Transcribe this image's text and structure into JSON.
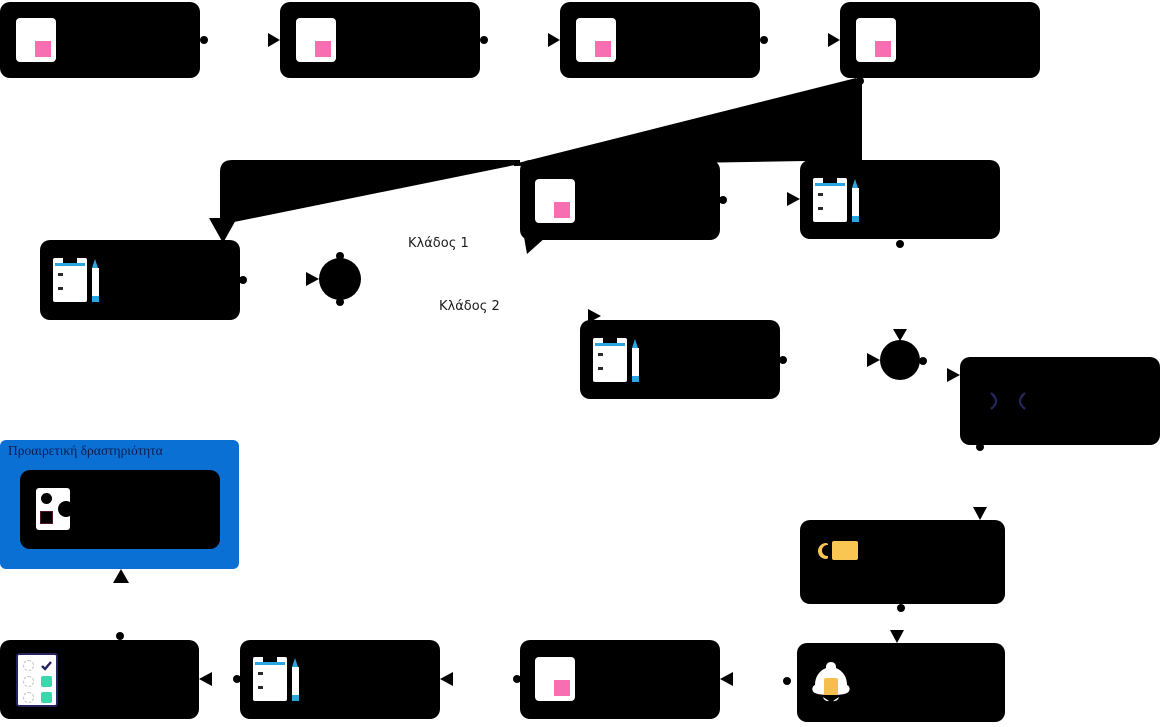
{
  "labels": {
    "branch1": "Κλάδος 1",
    "branch2": "Κλάδος 2",
    "optional_group": "Προαιρετική δραστηριότητα"
  },
  "colors": {
    "node_black": "#000000",
    "canvas_white": "#ffffff",
    "group_blue": "#0b70d4",
    "note_pink": "#f76fb0",
    "pen_blue": "#2aa7e0",
    "check_teal": "#3bd6ac",
    "check_navy": "#23235f",
    "bell_yellow": "#f5bf4e",
    "tag_yellow": "#f9c654",
    "code_navy": "#26265e",
    "label_navy": "#0d1c52",
    "label_dark": "#1a1a1a"
  },
  "icons": {
    "note": "sticky-note",
    "form": "clipboard-with-pen",
    "checklist": "task-checklist",
    "media": "shapes",
    "bell": "notification-bell",
    "tag": "label-tag",
    "code": "angle-brackets",
    "gateway": "filled-circle"
  },
  "nodes": [
    {
      "id": "task-1",
      "icon": "note"
    },
    {
      "id": "task-2",
      "icon": "note"
    },
    {
      "id": "task-3",
      "icon": "note"
    },
    {
      "id": "task-4",
      "icon": "note"
    },
    {
      "id": "note-mid",
      "icon": "note"
    },
    {
      "id": "form-right",
      "icon": "form"
    },
    {
      "id": "form-left",
      "icon": "form"
    },
    {
      "id": "gateway-1",
      "icon": "gateway"
    },
    {
      "id": "form-branch2",
      "icon": "form"
    },
    {
      "id": "gateway-2",
      "icon": "gateway"
    },
    {
      "id": "code-node",
      "icon": "code"
    },
    {
      "id": "optional-media",
      "icon": "media"
    },
    {
      "id": "tag-node",
      "icon": "tag"
    },
    {
      "id": "bell-node",
      "icon": "bell"
    },
    {
      "id": "note-bottom",
      "icon": "note"
    },
    {
      "id": "form-bottom",
      "icon": "form"
    },
    {
      "id": "checklist-node",
      "icon": "checklist"
    }
  ]
}
